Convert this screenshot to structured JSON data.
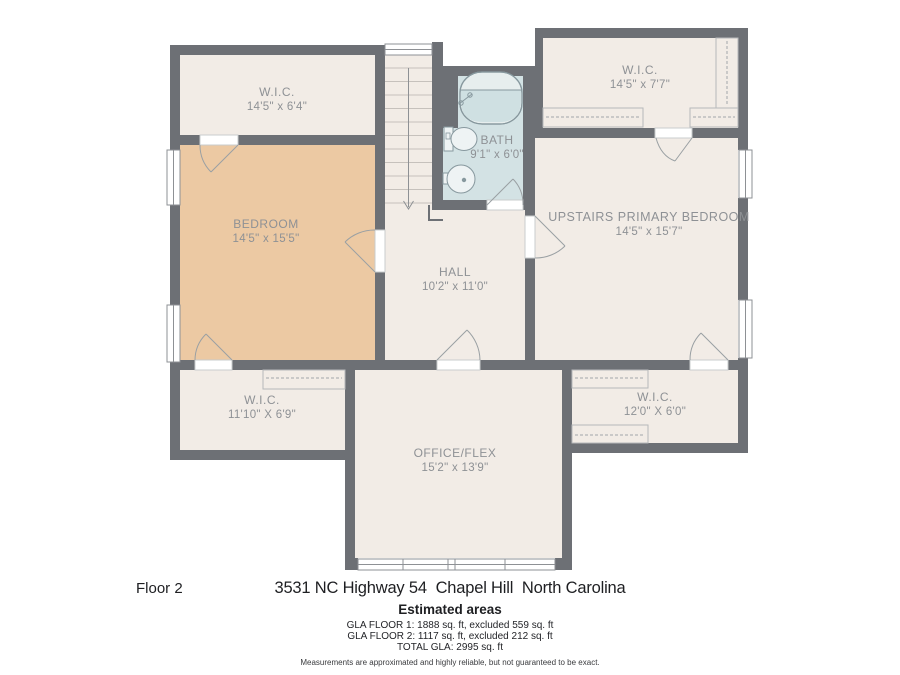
{
  "plan": {
    "floor_label": "Floor 2",
    "address": "3531 NC Highway 54  Chapel Hill  North Carolina",
    "estimated_title": "Estimated areas",
    "gla_lines": [
      "GLA FLOOR 1: 1888 sq. ft, excluded 559 sq. ft",
      "GLA FLOOR 2: 1117 sq. ft, excluded 212 sq. ft",
      "TOTAL GLA: 2995 sq. ft"
    ],
    "disclaimer": "Measurements are approximated and highly reliable, but not guaranteed to be exact.",
    "colors": {
      "wall": "#6d7075",
      "room_fill": "#f2ece6",
      "bedroom_fill": "#ecc9a3",
      "bath_fill": "#d3e2e4",
      "label_text": "#8e9195"
    },
    "rooms": [
      {
        "id": "wic-top-left",
        "name": "W.I.C.",
        "dims": "14'5\" x 6'4\""
      },
      {
        "id": "bath",
        "name": "BATH",
        "dims": "9'1\" x 6'0\""
      },
      {
        "id": "wic-top-right",
        "name": "W.I.C.",
        "dims": "14'5\" x 7'7\""
      },
      {
        "id": "bedroom",
        "name": "BEDROOM",
        "dims": "14'5\" x 15'5\""
      },
      {
        "id": "primary",
        "name": "UPSTAIRS PRIMARY BEDROOM",
        "dims": "14'5\" x 15'7\""
      },
      {
        "id": "hall",
        "name": "HALL",
        "dims": "10'2\" x 11'0\""
      },
      {
        "id": "wic-bottom-left",
        "name": "W.I.C.",
        "dims": "11'10\" X 6'9\""
      },
      {
        "id": "wic-bottom-right",
        "name": "W.I.C.",
        "dims": "12'0\" X 6'0\""
      },
      {
        "id": "office",
        "name": "OFFICE/FLEX",
        "dims": "15'2\" x 13'9\""
      }
    ]
  }
}
